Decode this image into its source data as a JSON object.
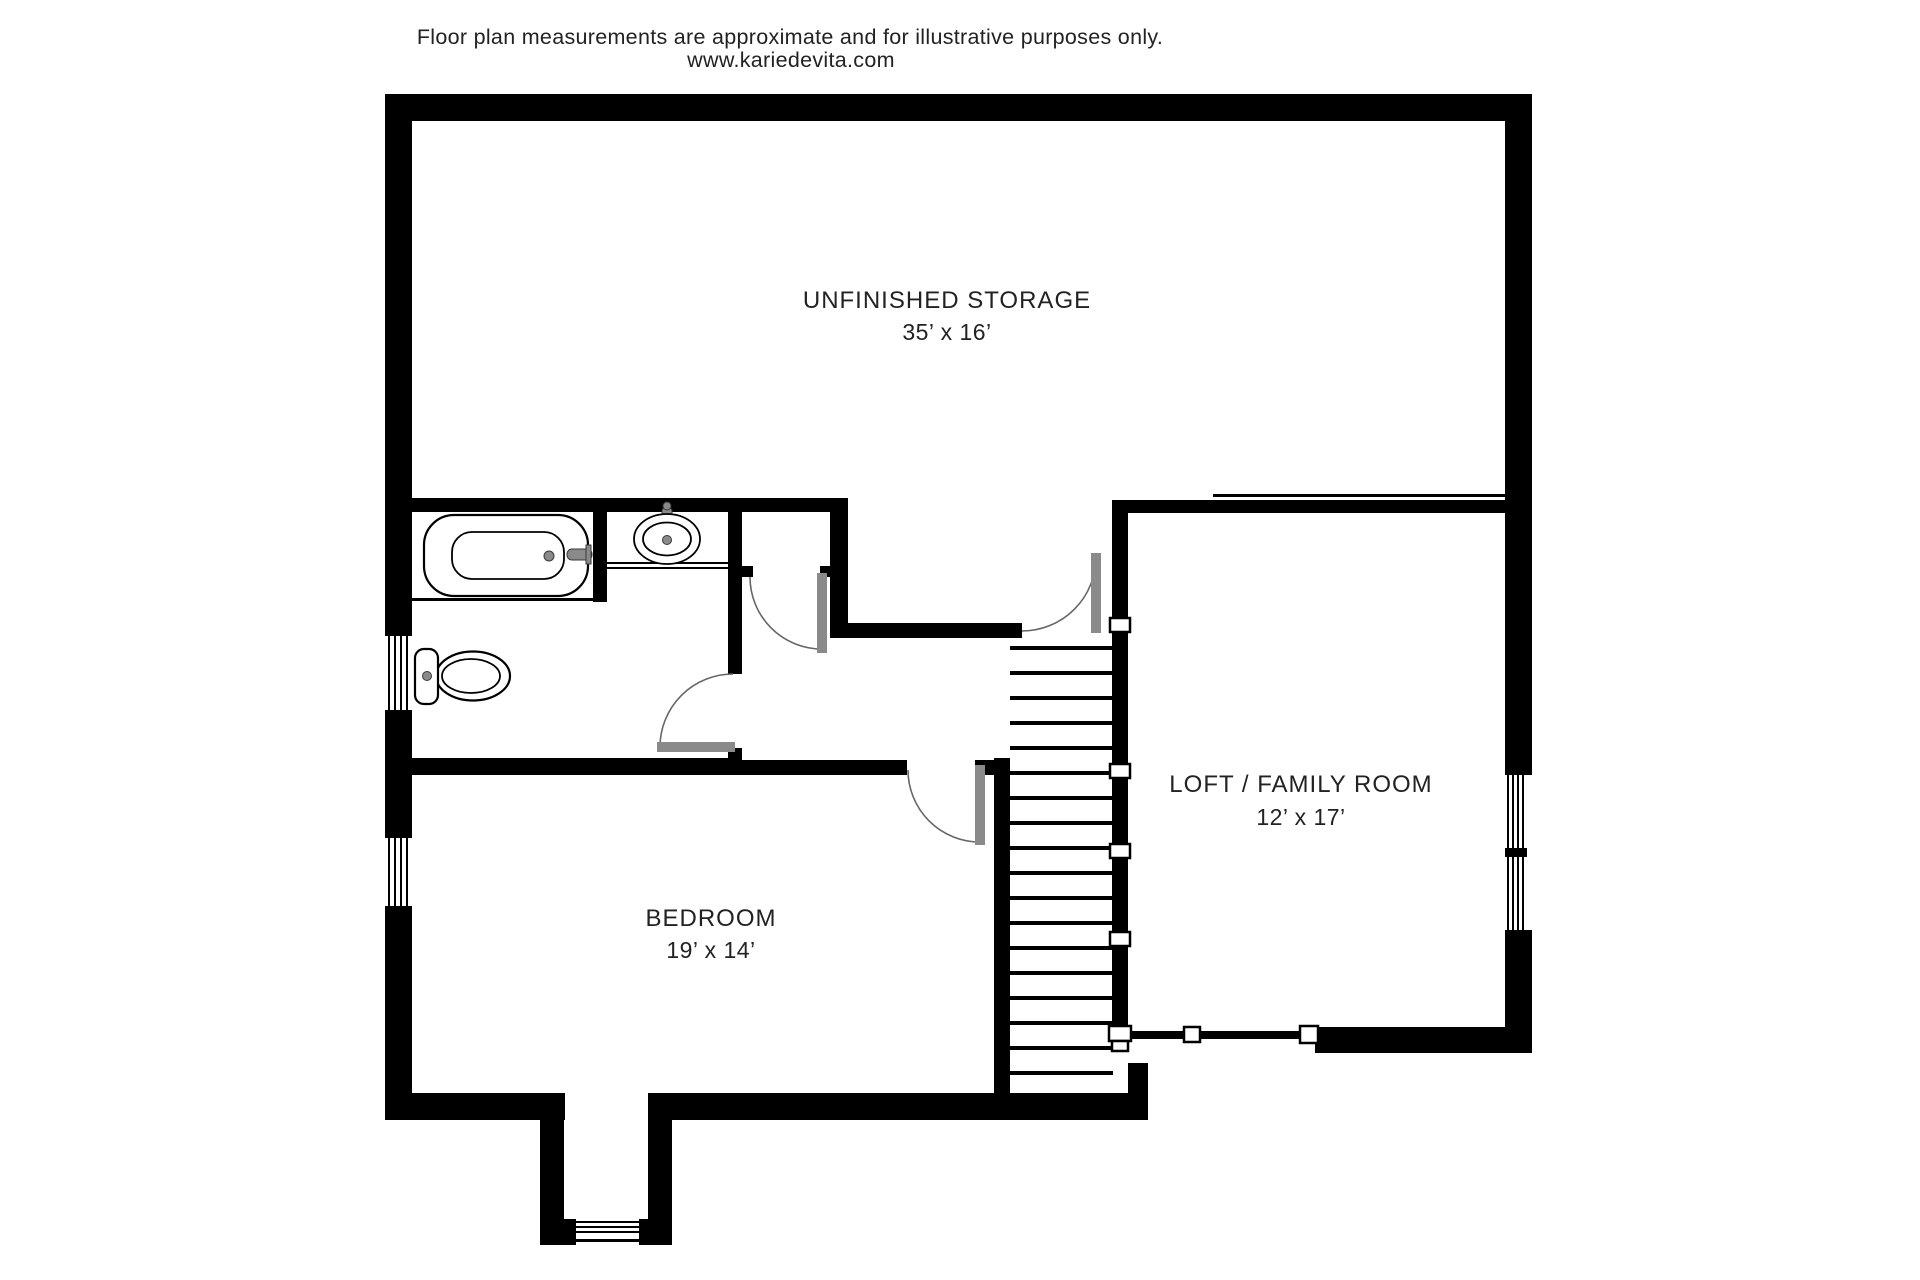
{
  "header": {
    "disclaimer": "Floor plan measurements are approximate and for illustrative purposes only.",
    "website": "www.kariedevita.com"
  },
  "rooms": {
    "storage": {
      "name": "UNFINISHED STORAGE",
      "dimensions": "35’ x 16’"
    },
    "loft": {
      "name": "LOFT / FAMILY ROOM",
      "dimensions": "12’ x 17’"
    },
    "bedroom": {
      "name": "BEDROOM",
      "dimensions": "19’ x 14’"
    }
  },
  "fixtures": [
    "bathtub-icon",
    "sink-icon",
    "toilet-icon",
    "staircase-icon",
    "door-swing-icon",
    "window-icon"
  ],
  "colors": {
    "wall": "#000000",
    "door_panel": "#8a8a8a",
    "arc": "#666666",
    "text": "#222222",
    "background": "#ffffff"
  }
}
